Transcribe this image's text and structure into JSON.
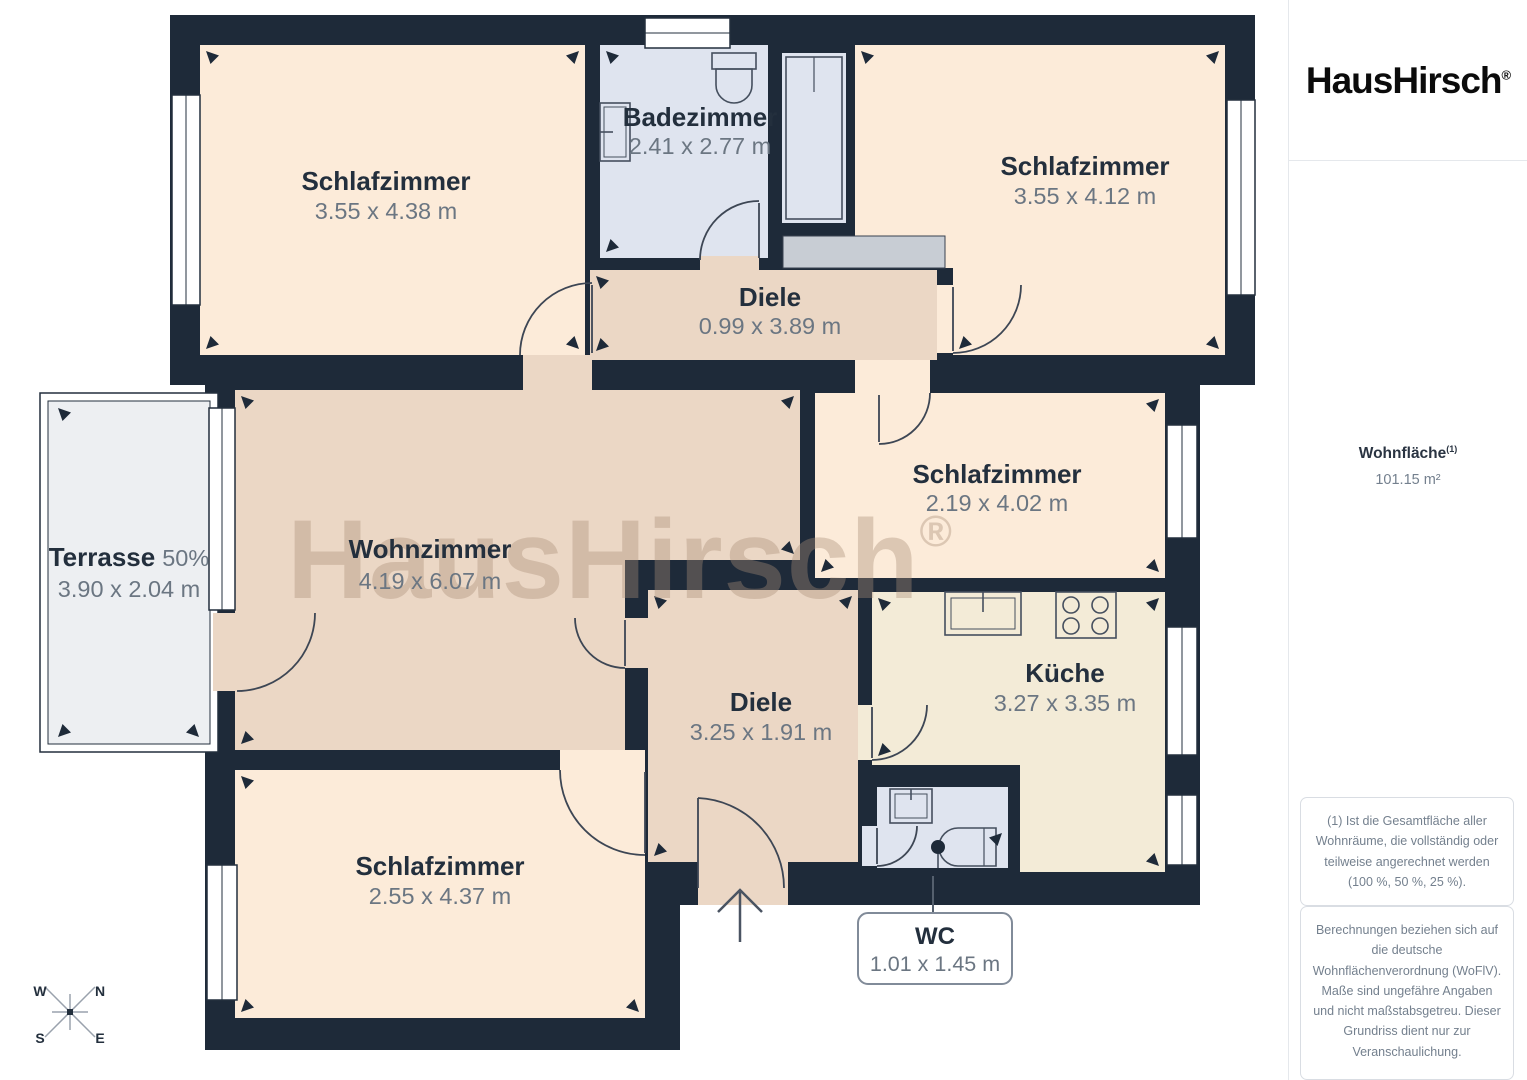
{
  "brand": {
    "logo_text": "HausHirsch",
    "registered_mark": "®"
  },
  "watermark": {
    "text": "HausHirsch",
    "registered_mark": "®"
  },
  "sidebar": {
    "area_label": "Wohnfläche",
    "area_footnote_marker": "(1)",
    "area_value": "101.15 m²",
    "note1": "(1) Ist die Gesamtfläche aller Wohnräume, die vollständig oder teilweise angerechnet werden (100 %, 50 %, 25 %).",
    "note2": "Berechnungen beziehen sich auf die deutsche Wohnflächenverordnung (WoFlV). Maße sind ungefähre Angaben und nicht maßstabsgetreu. Dieser Grundriss dient nur zur Veranschaulichung.",
    "credit_brand": "GIRAFFE",
    "credit_number": "360"
  },
  "compass": {
    "north": "N",
    "south": "S",
    "east": "E",
    "west": "W"
  },
  "rooms": {
    "bedroom_top_left": {
      "name": "Schlafzimmer",
      "dims": "3.55 x 4.38 m"
    },
    "bathroom": {
      "name": "Badezimmer",
      "dims": "2.41 x 2.77 m"
    },
    "bedroom_top_right": {
      "name": "Schlafzimmer",
      "dims": "3.55 x 4.12 m"
    },
    "hall_top": {
      "name": "Diele",
      "dims": "0.99 x 3.89 m"
    },
    "bedroom_middle": {
      "name": "Schlafzimmer",
      "dims": "2.19 x 4.02 m"
    },
    "living_room": {
      "name": "Wohnzimmer",
      "dims": "4.19 x 6.07 m"
    },
    "terrace": {
      "name": "Terrasse",
      "share": "50%",
      "dims": "3.90 x 2.04 m"
    },
    "hall_bottom": {
      "name": "Diele",
      "dims": "3.25 x 1.91 m"
    },
    "kitchen": {
      "name": "Küche",
      "dims": "3.27 x 3.35 m"
    },
    "bedroom_bottom": {
      "name": "Schlafzimmer",
      "dims": "2.55 x 4.37 m"
    },
    "wc": {
      "name": "WC",
      "dims": "1.01 x 1.45 m"
    }
  },
  "colors": {
    "wall": "#1e2a39",
    "room_peach": "#fcebd9",
    "room_tan": "#ebd7c5",
    "room_cream": "#f3ebd7",
    "room_blue": "#dfe4ef",
    "wardrobe_gray": "#c8cdd4",
    "terrace_gray": "#edeff2",
    "label_dark": "#232f3d",
    "label_gray": "#6b7682"
  }
}
